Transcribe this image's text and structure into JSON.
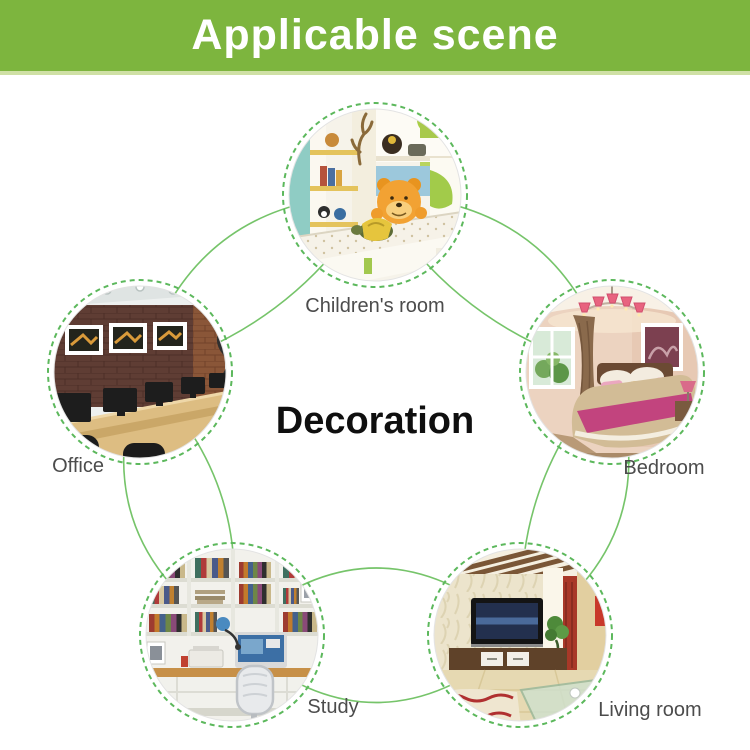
{
  "banner": {
    "title": "Applicable scene"
  },
  "center_label": "Decoration",
  "scenes": {
    "childrens_room": {
      "label": "Children's room"
    },
    "bedroom": {
      "label": "Bedroom"
    },
    "living_room": {
      "label": "Living room"
    },
    "study": {
      "label": "Study"
    },
    "office": {
      "label": "Office"
    }
  },
  "colors": {
    "banner_green": "#7db53e",
    "banner_underline": "#cfe0a5",
    "dashed_ring_green": "#5cb85c",
    "arc_green": "#76c46a",
    "label_gray": "#4c4c4c",
    "banner_text": "#ffffff",
    "center_text": "#0f0f0f",
    "background": "#ffffff"
  }
}
